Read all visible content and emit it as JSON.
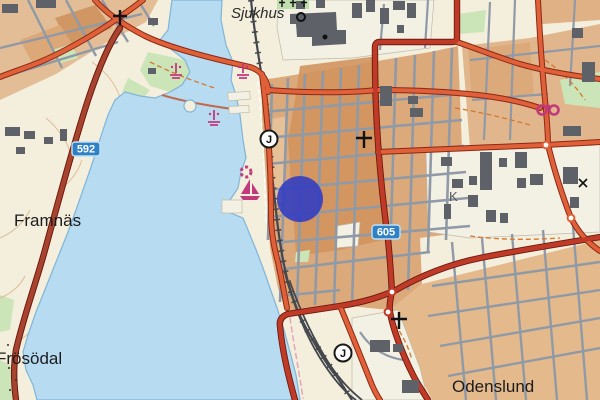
{
  "map_type": "topographic-city-map",
  "colors": {
    "water": "#B7DCF2",
    "land_cream": "#F4EEDC",
    "city_block_orange": "#DCA97B",
    "city_block_dark_orange": "#D2935E",
    "city_block_light": "#E6C096",
    "major_road_orange": "#E0603A",
    "major_road_dark_red": "#A8432F",
    "highway_red": "#C03A28",
    "street_gray": "#8F9AA6",
    "building_gray": "#5E6268",
    "green_area": "#CBE5B8",
    "railway_dark": "#44484D",
    "badge_blue": "#2F80C4",
    "marker_blue": "#2F3BC1",
    "poi_magenta": "#C13A7C"
  },
  "labels": {
    "sjukhus": "Sjukhus",
    "framnas": "Framnäs",
    "frosodal": "Frösödal",
    "odenslund": "Odenslund",
    "block_k": "K"
  },
  "road_badges": [
    {
      "number": "592"
    },
    {
      "number": "605"
    }
  ],
  "railway_stations": [
    {
      "letter": "J",
      "x": 269,
      "y": 139
    },
    {
      "letter": "J",
      "x": 343,
      "y": 353
    }
  ],
  "marker": {
    "shape": "circle",
    "x": 300,
    "y": 199,
    "radius": 23,
    "opacity": 0.88
  },
  "icons": [
    {
      "name": "church-cross-icon",
      "x": 120,
      "y": 17
    },
    {
      "name": "church-cross-icon",
      "x": 364,
      "y": 139
    },
    {
      "name": "church-cross-icon",
      "x": 399,
      "y": 320
    },
    {
      "name": "cemetery-crosses-icon",
      "x": 292,
      "y": 3
    },
    {
      "name": "harbor-lifebuoy-icon",
      "x": 246,
      "y": 172
    },
    {
      "name": "sailboat-icon",
      "x": 250,
      "y": 190
    },
    {
      "name": "bathing-place-icon",
      "x": 176,
      "y": 71
    },
    {
      "name": "bathing-place-icon",
      "x": 214,
      "y": 118
    },
    {
      "name": "bathing-place-icon",
      "x": 243,
      "y": 71
    },
    {
      "name": "sports-facility-icon",
      "x": 548,
      "y": 110
    },
    {
      "name": "mast-icon",
      "x": 583,
      "y": 183
    },
    {
      "name": "chimney-icon",
      "x": 301,
      "y": 17
    }
  ]
}
